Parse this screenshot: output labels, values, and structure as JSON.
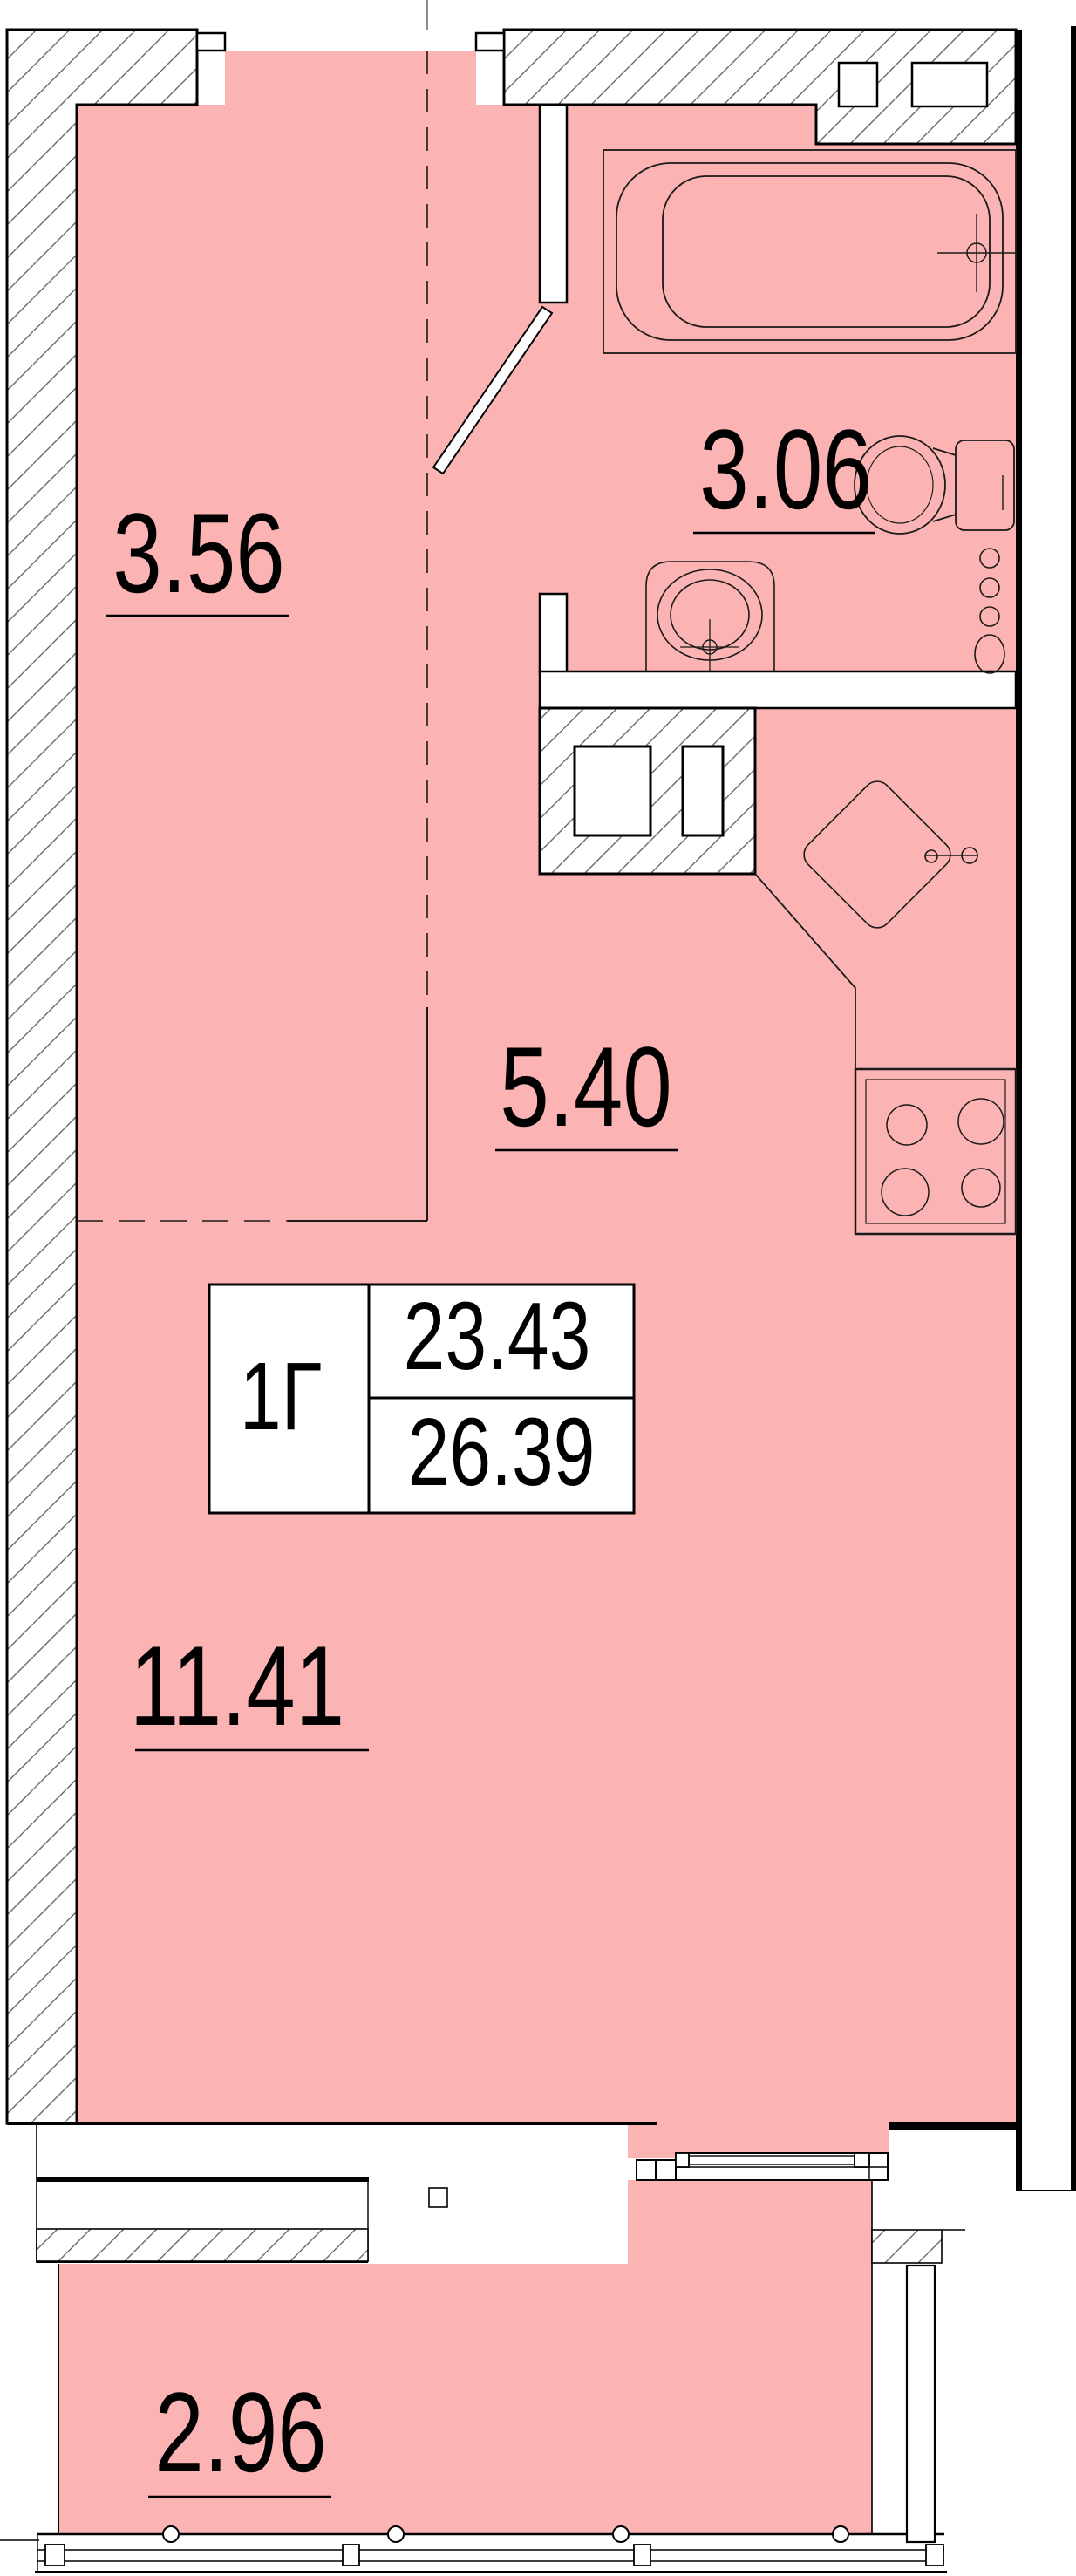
{
  "plan": {
    "title": "apartment-floor-plan",
    "unit_table": {
      "unit_id": "1Г",
      "living_area": "23.43",
      "total_area": "26.39"
    },
    "rooms": [
      {
        "name": "hallway",
        "area": "3.56"
      },
      {
        "name": "bathroom",
        "area": "3.06"
      },
      {
        "name": "kitchen-zone",
        "area": "5.40"
      },
      {
        "name": "living-zone",
        "area": "11.41"
      },
      {
        "name": "balcony",
        "area": "2.96"
      }
    ],
    "colors": {
      "room_fill": "#FBB3B3",
      "wall_line": "#000000",
      "hatch_line": "#6b6b6b"
    }
  }
}
